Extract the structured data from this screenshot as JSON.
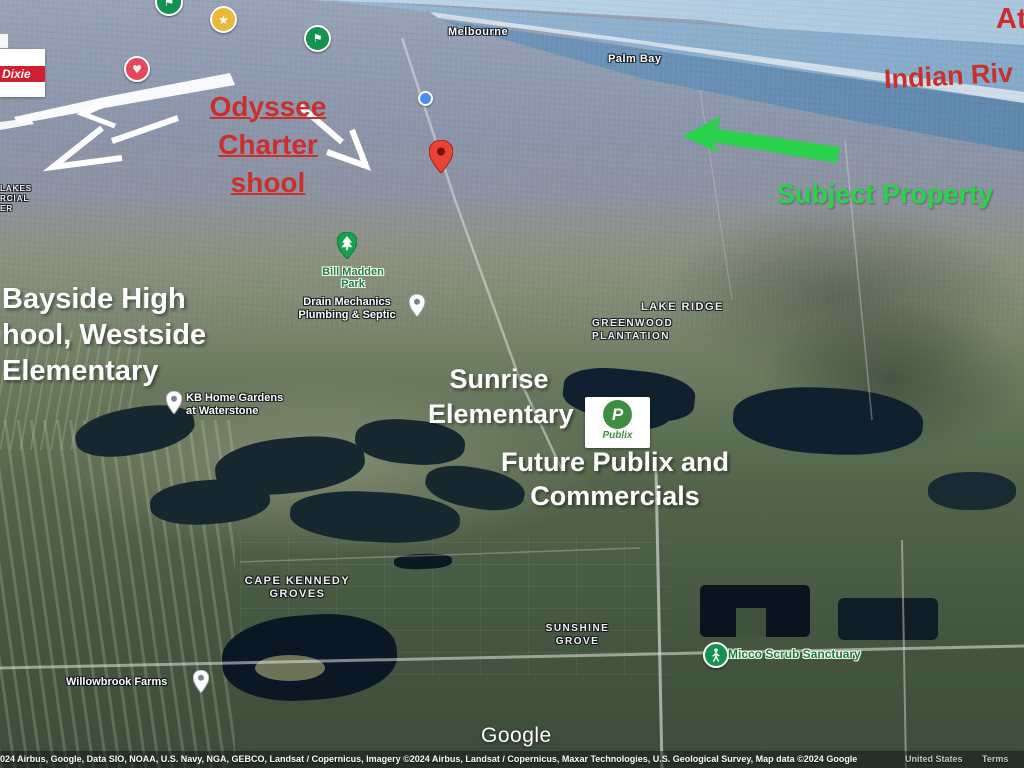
{
  "colors": {
    "annotation_red": "#c9302c",
    "annotation_green": "#2bd24b",
    "publix_green": "#3e8e41",
    "pin_red": "#ea4335",
    "marker_flag_green": "#12934f",
    "marker_star_gold": "#edb73d",
    "marker_heart_red": "#e8465a",
    "dot_blue": "#4a8df0",
    "poi_label_green": "#1b7c38"
  },
  "icons": {
    "star": "★",
    "heart": "♥",
    "flag": "⚑"
  },
  "legend": {
    "winn_dixie": "Dixie"
  },
  "city_labels": {
    "melbourne": "Melbourne",
    "palm_bay": "Palm Bay"
  },
  "area_labels": {
    "lakes_partial": [
      "LAKES",
      "RCIAL",
      "ER"
    ],
    "lake_ridge": "LAKE RIDGE",
    "greenwood": [
      "GREENWOOD",
      "PLANTATION"
    ],
    "cape_kennedy": [
      "CAPE KENNEDY",
      "GROVES"
    ],
    "sunshine": [
      "SUNSHINE",
      "GROVE"
    ]
  },
  "poi": {
    "bill_madden": [
      "Bill Madden",
      "Park"
    ],
    "drain_mechanics": [
      "Drain Mechanics",
      "Plumbing & Septic"
    ],
    "kb_home": [
      "KB Home Gardens",
      "at Waterstone"
    ],
    "micco": "Micco Scrub Sanctuary",
    "willowbrook": "Willowbrook Farms",
    "publix_p": "P",
    "publix_name": "Publix"
  },
  "annotations": {
    "odyssee": [
      "Odyssee Charter",
      "shool"
    ],
    "atlantic_partial": "At",
    "indian_river_partial": "Indian Riv",
    "subject_property": "Subject Property",
    "bayside": [
      "Bayside High",
      "hool, Westside",
      "Elementary"
    ],
    "sunrise": [
      "Sunrise",
      "Elementary"
    ],
    "future_publix": [
      "Future Publix and",
      "Commercials"
    ]
  },
  "footer": {
    "google_logo": "Google",
    "attribution": "024 Airbus, Google, Data SIO, NOAA, U.S. Navy, NGA, GEBCO, Landsat / Copernicus, Imagery ©2024 Airbus, Landsat / Copernicus, Maxar Technologies, U.S. Geological Survey, Map data ©2024 Google",
    "region": "United States",
    "terms": "Terms"
  }
}
